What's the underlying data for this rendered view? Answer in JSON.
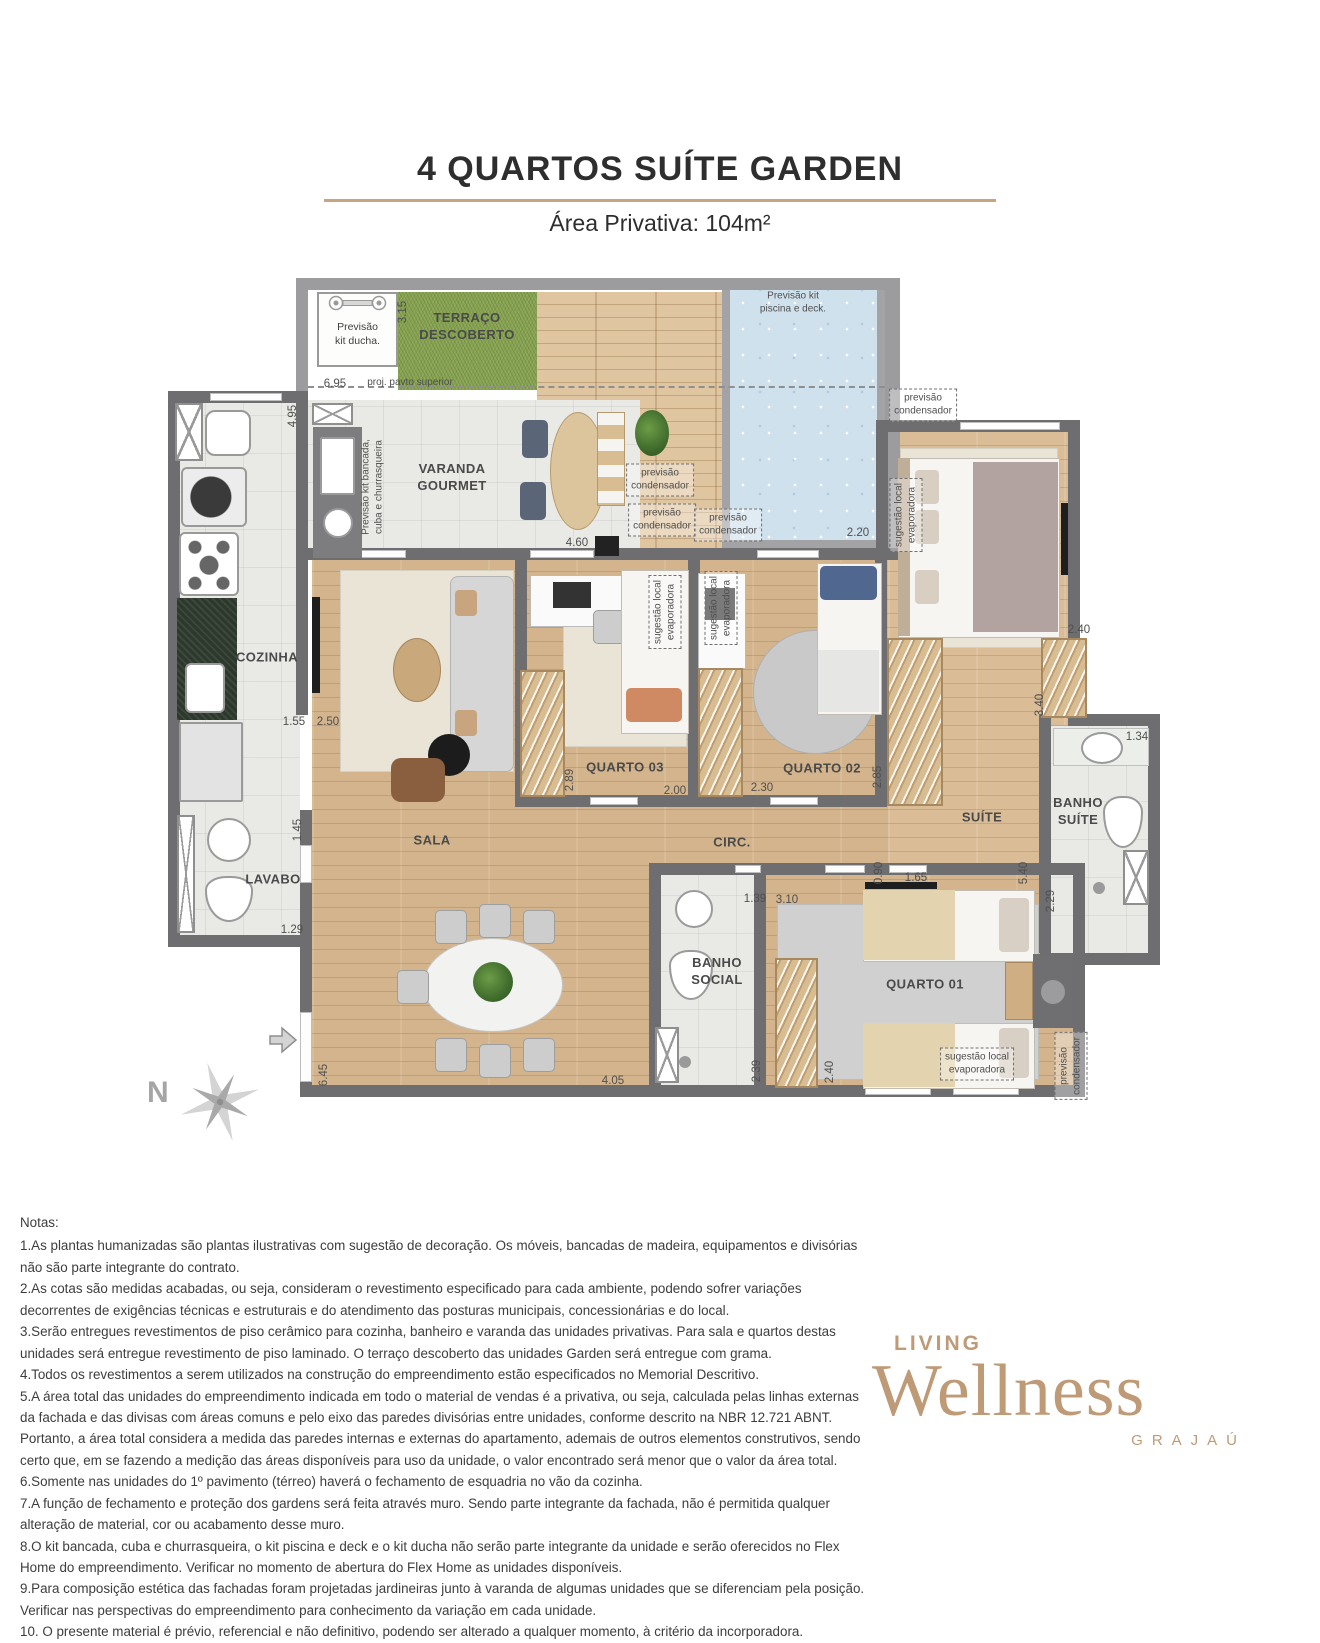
{
  "header": {
    "title": "4 QUARTOS SUÍTE GARDEN",
    "subtitle": "Área Privativa: 104m²"
  },
  "plan": {
    "compass_label": "N",
    "kit_ducha_label": "Previsão\nkit ducha.",
    "rooms": [
      {
        "n": "room-label-terraco",
        "t": "TERRAÇO\nDESCOBERTO",
        "x": 302,
        "y": 57
      },
      {
        "n": "room-label-varanda",
        "t": "VARANDA\nGOURMET",
        "x": 287,
        "y": 208
      },
      {
        "n": "room-label-cozinha",
        "t": "COZINHA",
        "x": 102,
        "y": 388
      },
      {
        "n": "room-label-sala",
        "t": "SALA",
        "x": 267,
        "y": 571
      },
      {
        "n": "room-label-lavabo",
        "t": "LAVABO",
        "x": 108,
        "y": 610
      },
      {
        "n": "room-label-quarto-03",
        "t": "QUARTO 03",
        "x": 460,
        "y": 498
      },
      {
        "n": "room-label-quarto-02",
        "t": "QUARTO 02",
        "x": 657,
        "y": 499
      },
      {
        "n": "room-label-suite",
        "t": "SUÍTE",
        "x": 817,
        "y": 548
      },
      {
        "n": "room-label-banho-suite",
        "t": "BANHO\nSUÍTE",
        "x": 913,
        "y": 542
      },
      {
        "n": "room-label-circ",
        "t": "CIRC.",
        "x": 567,
        "y": 573
      },
      {
        "n": "room-label-banho-social",
        "t": "BANHO\nSOCIAL",
        "x": 552,
        "y": 702
      },
      {
        "n": "room-label-quarto-01",
        "t": "QUARTO 01",
        "x": 760,
        "y": 715
      }
    ],
    "dims": [
      {
        "t": "3.15",
        "x": 238,
        "y": 42,
        "v": 1
      },
      {
        "t": "6.95",
        "x": 170,
        "y": 114
      },
      {
        "t": "4.95",
        "x": 128,
        "y": 146,
        "v": 1
      },
      {
        "t": "4.60",
        "x": 412,
        "y": 273
      },
      {
        "t": "2.20",
        "x": 693,
        "y": 263
      },
      {
        "t": "2.40",
        "x": 914,
        "y": 360
      },
      {
        "t": "3.40",
        "x": 875,
        "y": 435,
        "v": 1
      },
      {
        "t": "1.34",
        "x": 972,
        "y": 467
      },
      {
        "t": "1.55",
        "x": 129,
        "y": 452
      },
      {
        "t": "2.50",
        "x": 163,
        "y": 452
      },
      {
        "t": "2.89",
        "x": 405,
        "y": 510,
        "v": 1
      },
      {
        "t": "2.00",
        "x": 510,
        "y": 521
      },
      {
        "t": "2.30",
        "x": 597,
        "y": 518
      },
      {
        "t": "2.85",
        "x": 713,
        "y": 507,
        "v": 1
      },
      {
        "t": "1.45",
        "x": 133,
        "y": 560,
        "v": 1
      },
      {
        "t": "1.29",
        "x": 127,
        "y": 660
      },
      {
        "t": "0.90",
        "x": 714,
        "y": 603,
        "v": 1
      },
      {
        "t": "1.65",
        "x": 751,
        "y": 608
      },
      {
        "t": "5.40",
        "x": 859,
        "y": 603,
        "v": 1
      },
      {
        "t": "2.29",
        "x": 886,
        "y": 631,
        "v": 1
      },
      {
        "t": "1.39",
        "x": 590,
        "y": 629
      },
      {
        "t": "3.10",
        "x": 622,
        "y": 630
      },
      {
        "t": "2.39",
        "x": 592,
        "y": 801,
        "v": 1
      },
      {
        "t": "2.40",
        "x": 665,
        "y": 802,
        "v": 1
      },
      {
        "t": "4.05",
        "x": 448,
        "y": 811
      },
      {
        "t": "6.45",
        "x": 159,
        "y": 805,
        "v": 1
      }
    ],
    "annotations": [
      {
        "n": "annotation-proj-pavto",
        "t": "proj. pavto superior",
        "x": 245,
        "y": 113
      },
      {
        "n": "annotation-kit-piscina",
        "t": "Previsão kit\npiscina e deck.",
        "x": 628,
        "y": 33
      },
      {
        "n": "annotation-kit-bancada",
        "t": "Previsão kit bancada,\ncuba e churrasqueira",
        "x": 208,
        "y": 217,
        "v": 1
      },
      {
        "n": "annotation-condenser",
        "t": "previsão\ncondensador",
        "x": 495,
        "y": 210,
        "d": 1
      },
      {
        "n": "annotation-condenser",
        "t": "previsão\ncondensador",
        "x": 497,
        "y": 250,
        "d": 1
      },
      {
        "n": "annotation-condenser",
        "t": "previsão\ncondensador",
        "x": 563,
        "y": 255,
        "d": 1
      },
      {
        "n": "annotation-condenser",
        "t": "previsão\ncondensador",
        "x": 758,
        "y": 135,
        "d": 1
      },
      {
        "n": "annotation-condenser",
        "t": "previsão\ncondensador",
        "x": 906,
        "y": 796,
        "d": 1,
        "v": 1
      },
      {
        "n": "annotation-evaporator",
        "t": "sugestão local\nevaporadora",
        "x": 500,
        "y": 342,
        "d": 1,
        "v": 1
      },
      {
        "n": "annotation-evaporator",
        "t": "sugestão local\nevaporadora",
        "x": 556,
        "y": 338,
        "d": 1,
        "v": 1
      },
      {
        "n": "annotation-evaporator",
        "t": "sugestão local\nevaporadora",
        "x": 741,
        "y": 245,
        "d": 1,
        "v": 1
      },
      {
        "n": "annotation-evaporator",
        "t": "sugestão local\nevaporadora",
        "x": 812,
        "y": 794,
        "d": 1
      }
    ]
  },
  "notes": {
    "heading": "Notas:",
    "items": [
      "1.As plantas humanizadas são plantas ilustrativas com sugestão de decoração. Os móveis, bancadas de madeira, equipamentos e divisórias não são parte integrante do contrato.",
      "2.As cotas são medidas acabadas, ou seja, consideram o revestimento especificado para cada ambiente, podendo sofrer variações decorrentes de exigências técnicas e estruturais e do atendimento das posturas municipais, concessionárias e do local.",
      "3.Serão entregues revestimentos de piso cerâmico para cozinha, banheiro e varanda das unidades privativas. Para sala e quartos destas unidades será entregue revestimento de piso laminado. O terraço descoberto das unidades Garden será entregue com grama.",
      "4.Todos os revestimentos a serem utilizados na construção do empreendimento estão especificados no Memorial Descritivo.",
      "5.A área total das unidades do empreendimento indicada em todo o material de vendas é a privativa, ou seja, calculada pelas linhas externas da fachada e das divisas com áreas comuns e pelo eixo das paredes divisórias entre unidades, conforme descrito na NBR 12.721 ABNT. Portanto, a área total considera a medida das paredes internas e externas do apartamento, ademais de outros elementos construtivos, sendo certo que, em se fazendo a medição das áreas disponíveis para uso da unidade, o valor encontrado será menor que o valor da área total.",
      "6.Somente nas unidades do 1º pavimento (térreo) haverá o fechamento de esquadria no vão da cozinha.",
      "7.A função de fechamento e proteção dos gardens será feita através muro. Sendo parte integrante da fachada, não é permitida qualquer alteração de material, cor ou acabamento desse muro.",
      "8.O kit bancada, cuba e churrasqueira, o kit piscina e deck e o kit ducha não serão parte integrante da unidade e serão oferecidos no Flex Home do empreendimento. Verificar no momento de abertura do Flex Home as unidades disponíveis.",
      "9.Para composição estética das fachadas foram projetadas jardineiras junto à varanda de algumas unidades que se diferenciam pela posição. Verificar nas perspectivas do empreendimento para conhecimento da variação em cada unidade.",
      "10. O presente material é prévio, referencial e não definitivo, podendo ser alterado a qualquer momento, à critério da incorporadora."
    ]
  },
  "logo": {
    "top": "LIVING",
    "name": "Wellness",
    "sub": "GRAJAÚ"
  },
  "colors": {
    "accent_line": "#c9a47e",
    "logo": "#bf9a77",
    "wall": "#6e6e70",
    "grass": "#86a150",
    "pool": "#cfe1ed",
    "wood": "#d3b48c",
    "deck": "#e0c6a0"
  }
}
